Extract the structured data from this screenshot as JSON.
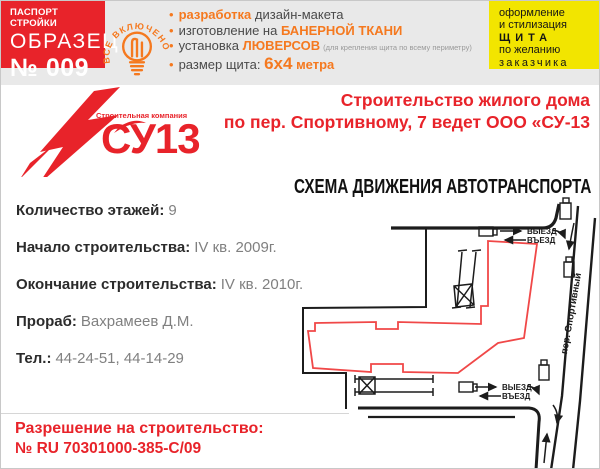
{
  "passport": {
    "kicker": "ПАСПОРТ СТРОЙКИ",
    "sample": "ОБРАЗЕЦ",
    "number": "№ 009"
  },
  "badge": {
    "text": "ВСЕ ВКЛЮЧЕНО"
  },
  "features": {
    "f1": {
      "hl": "разработка",
      "rest": " дизайн-макета"
    },
    "f2": {
      "pre": "изготовление на ",
      "hl": "БАНЕРНОЙ ТКАНИ"
    },
    "f3": {
      "pre": "установка ",
      "hl": "ЛЮВЕРСОВ",
      "note": "(для крепления щита по всему периметру)"
    },
    "f4": {
      "pre": "размер щита: ",
      "big": "6х4",
      "rest": " метра"
    }
  },
  "style_box": {
    "l1": "оформление",
    "l2": "и стилизация",
    "l3": "ЩИТА",
    "l4": "по желанию",
    "l5": "заказчика"
  },
  "brand": {
    "tagline": "Строительная компания",
    "name": "СУ13"
  },
  "title": {
    "line1": "Строительство жилого дома",
    "line2": "по пер. Спортивному, 7 ведет ООО «СУ-13"
  },
  "info": [
    {
      "label": "Количество этажей:",
      "value": "9"
    },
    {
      "label": "Начало строительства:",
      "value": "IV кв. 2009г."
    },
    {
      "label": "Окончание строительства:",
      "value": "IV кв. 2010г."
    },
    {
      "label": "Прораб:",
      "value": "Вахрамеев Д.М."
    },
    {
      "label": "Тел.:",
      "value": "44-24-51, 44-14-29"
    }
  ],
  "schema": {
    "title": "СХЕМА ДВИЖЕНИЯ АВТОТРАНСПОРТА",
    "street": "пер. Спортивный",
    "exit": "ВЫЕЗД",
    "enter": "ВЪЕЗД"
  },
  "permit": {
    "line1": "Разрешение на строительство:",
    "line2": "№ RU 70301000-385-С/09"
  },
  "colors": {
    "red": "#e8232a",
    "orange": "#f5791f",
    "yellow": "#f2e500",
    "band_gray": "#e9e9e9",
    "map_red": "#f04848",
    "line_black": "#1c1c1c"
  }
}
